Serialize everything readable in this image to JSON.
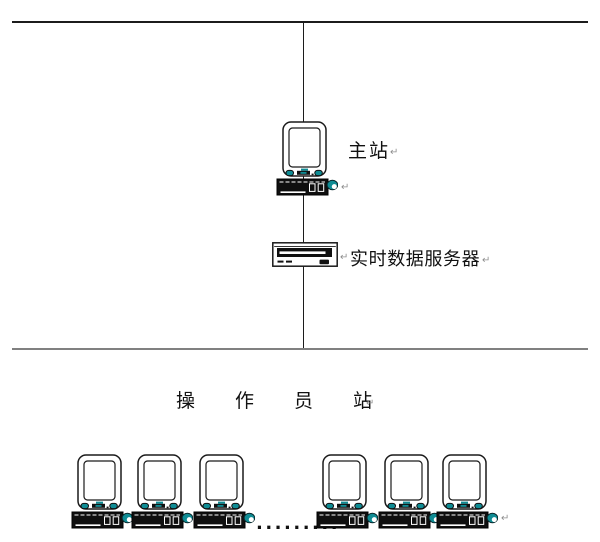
{
  "diagram": {
    "type": "network-topology",
    "labels": {
      "main_station": "主站",
      "realtime_server": "实时数据服务器",
      "operator_station": "操作员站",
      "ellipsis": "........."
    },
    "marks": {
      "return": "↵"
    },
    "colors": {
      "device_teal": "#0F8C94",
      "outline": "#1a1a1a",
      "bus_top": "#1c1c1c",
      "bus_bottom": "#808080"
    },
    "nodes": {
      "main_station_count": 1,
      "server_count": 1,
      "operator_workstation_count": 6
    }
  }
}
